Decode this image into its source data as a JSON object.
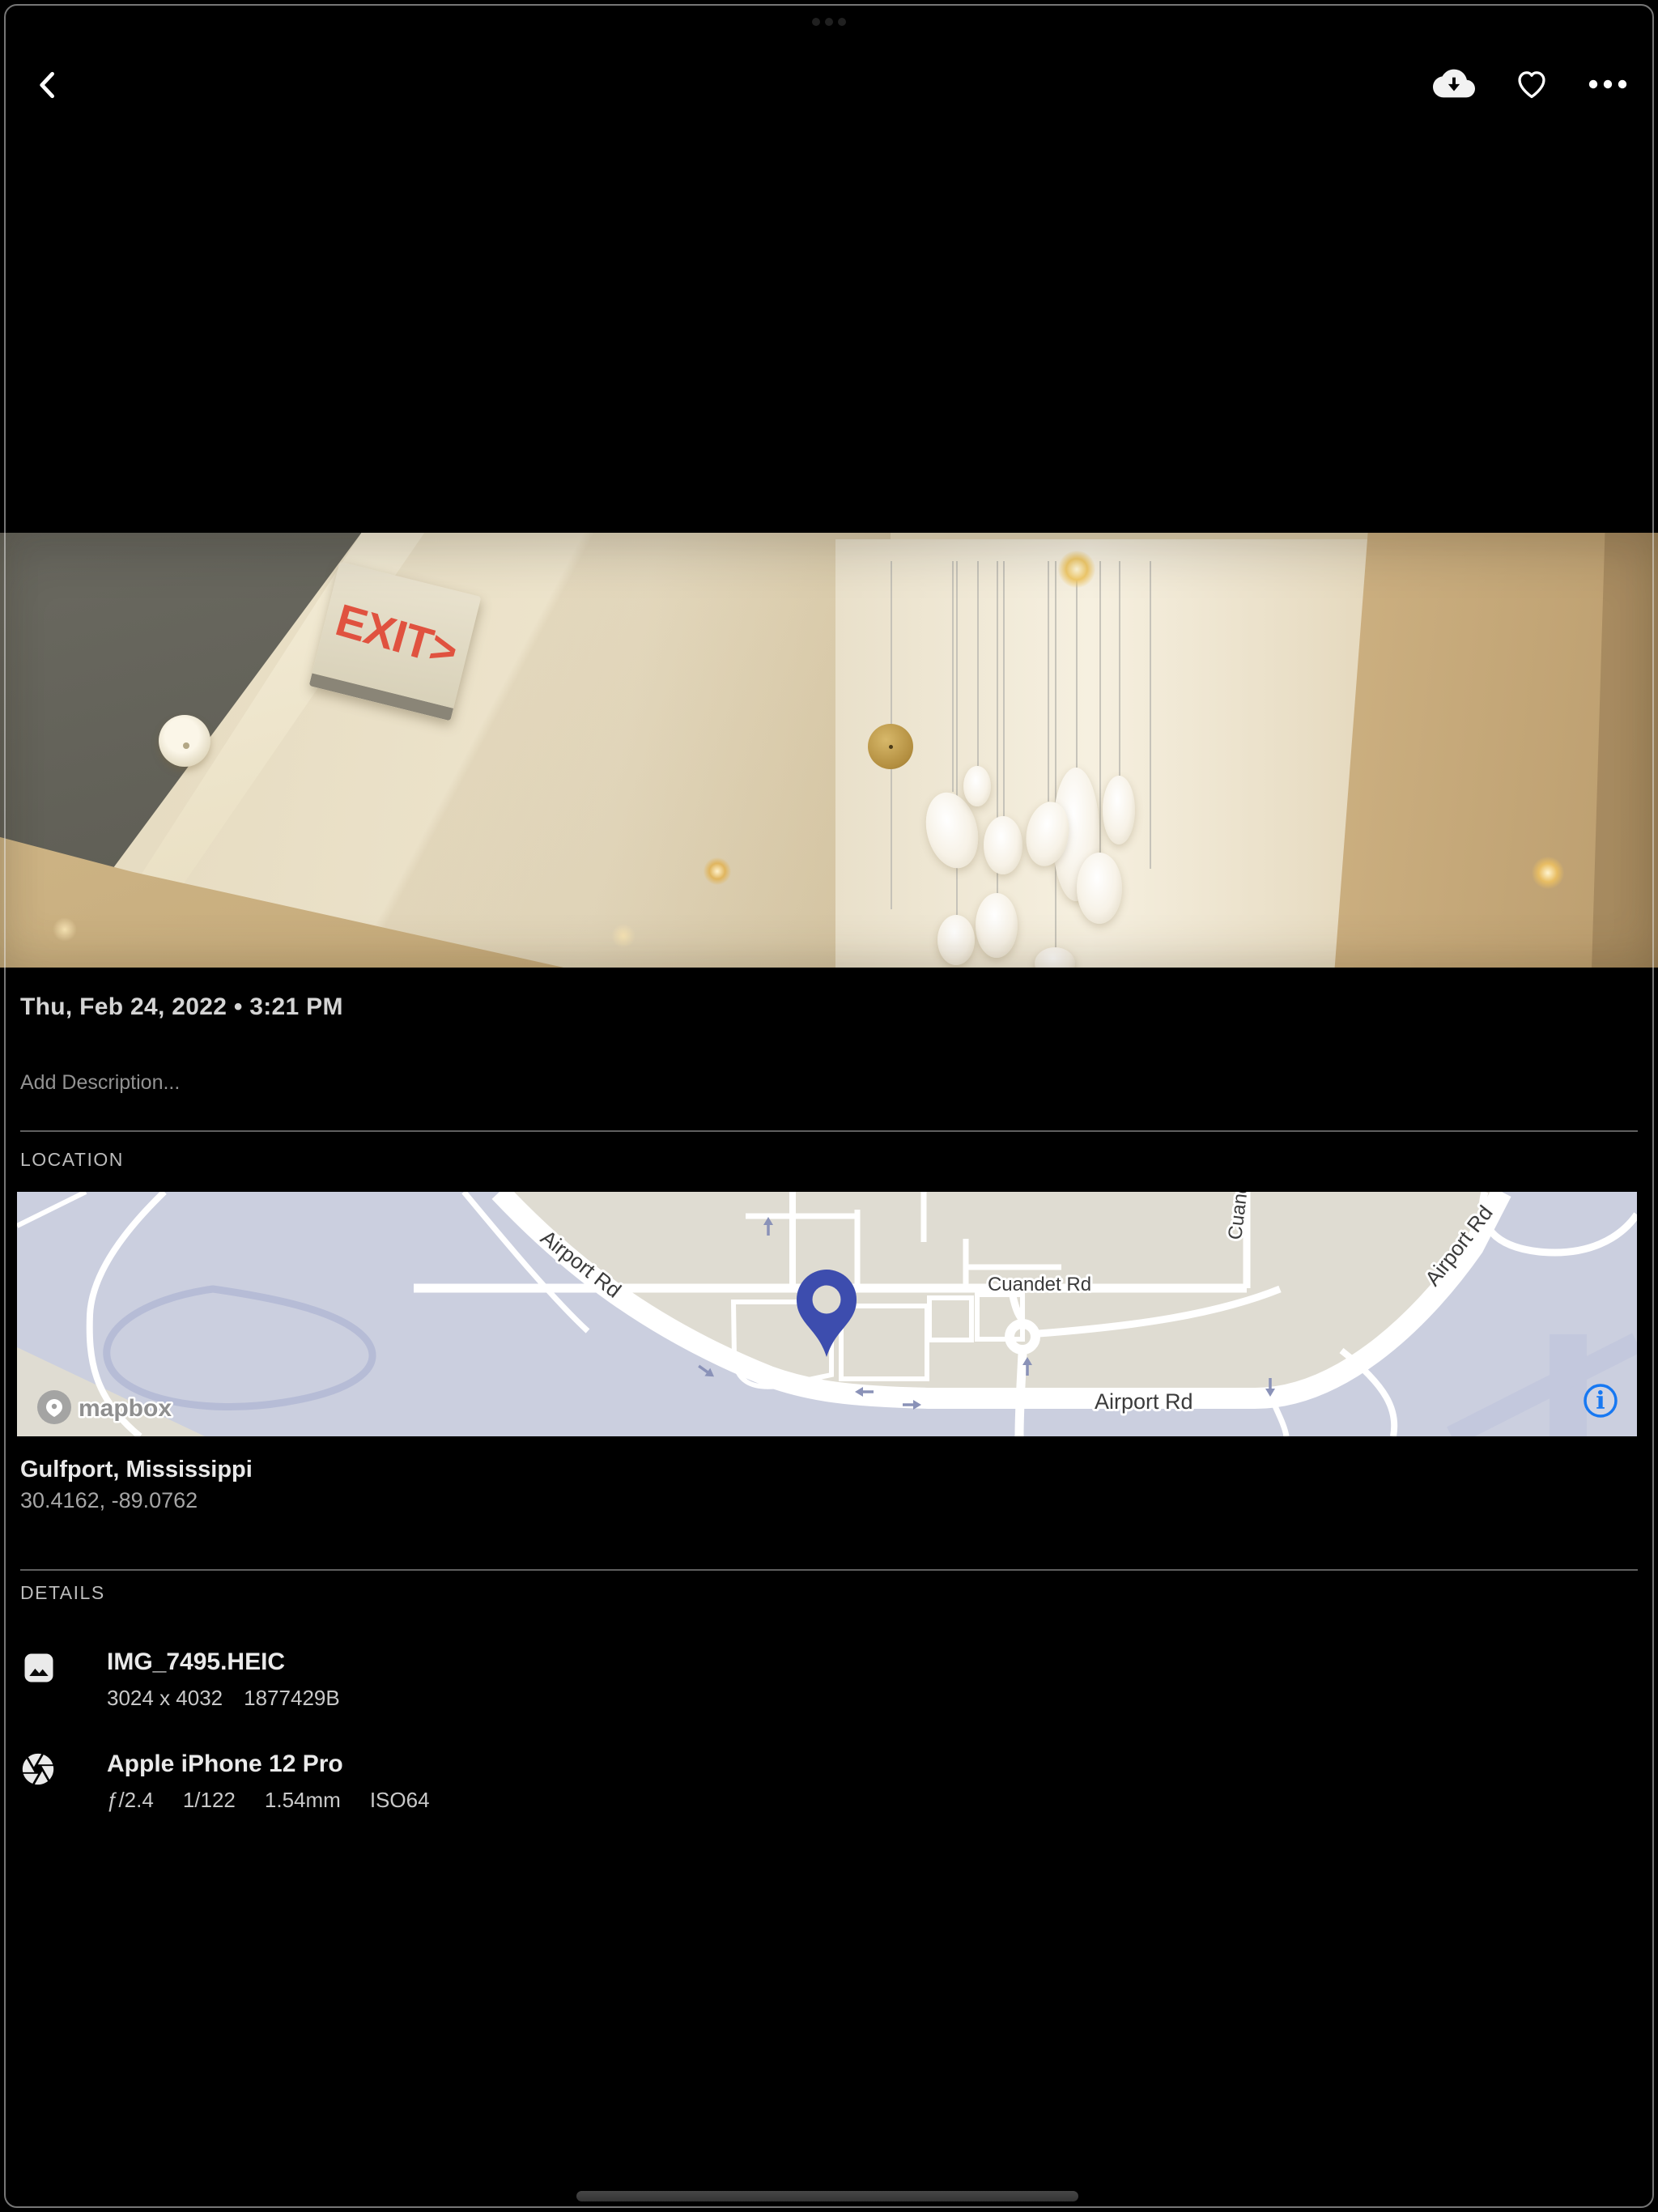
{
  "toolbar": {
    "back_icon": "chevron-left",
    "download_icon": "cloud-download",
    "favorite_icon": "heart-outline",
    "more_icon": "ellipsis"
  },
  "photo": {
    "exit_sign": "EXIT>"
  },
  "meta": {
    "datetime": "Thu, Feb 24, 2022 • 3:21 PM",
    "description_placeholder": "Add Description..."
  },
  "location": {
    "header": "LOCATION",
    "place": "Gulfport, Mississippi",
    "coordinates": "30.4162, -89.0762",
    "map": {
      "attribution": "mapbox",
      "road_label_diagonal": "Airport Rd",
      "road_label_cuandet": "Cuandet Rd",
      "road_label_bottom": "Airport Rd",
      "road_label_right_vertical": "Cuandet Rd",
      "road_label_right_diagonal": "Airport Rd",
      "info_button": "i"
    }
  },
  "details": {
    "header": "DETAILS",
    "file": {
      "name": "IMG_7495.HEIC",
      "dimensions": "3024 x 4032",
      "size_bytes": "1877429B"
    },
    "camera": {
      "model": "Apple iPhone 12 Pro",
      "aperture": "ƒ/2.4",
      "shutter_speed": "1/122",
      "focal_length": "1.54mm",
      "iso": "ISO64"
    }
  },
  "colors": {
    "accent_blue": "#1778F2",
    "pin_indigo": "#3D4DAE",
    "exit_red": "#E0523F",
    "map_beige": "#DFDCD2",
    "map_lavender": "#CBCFDF"
  }
}
